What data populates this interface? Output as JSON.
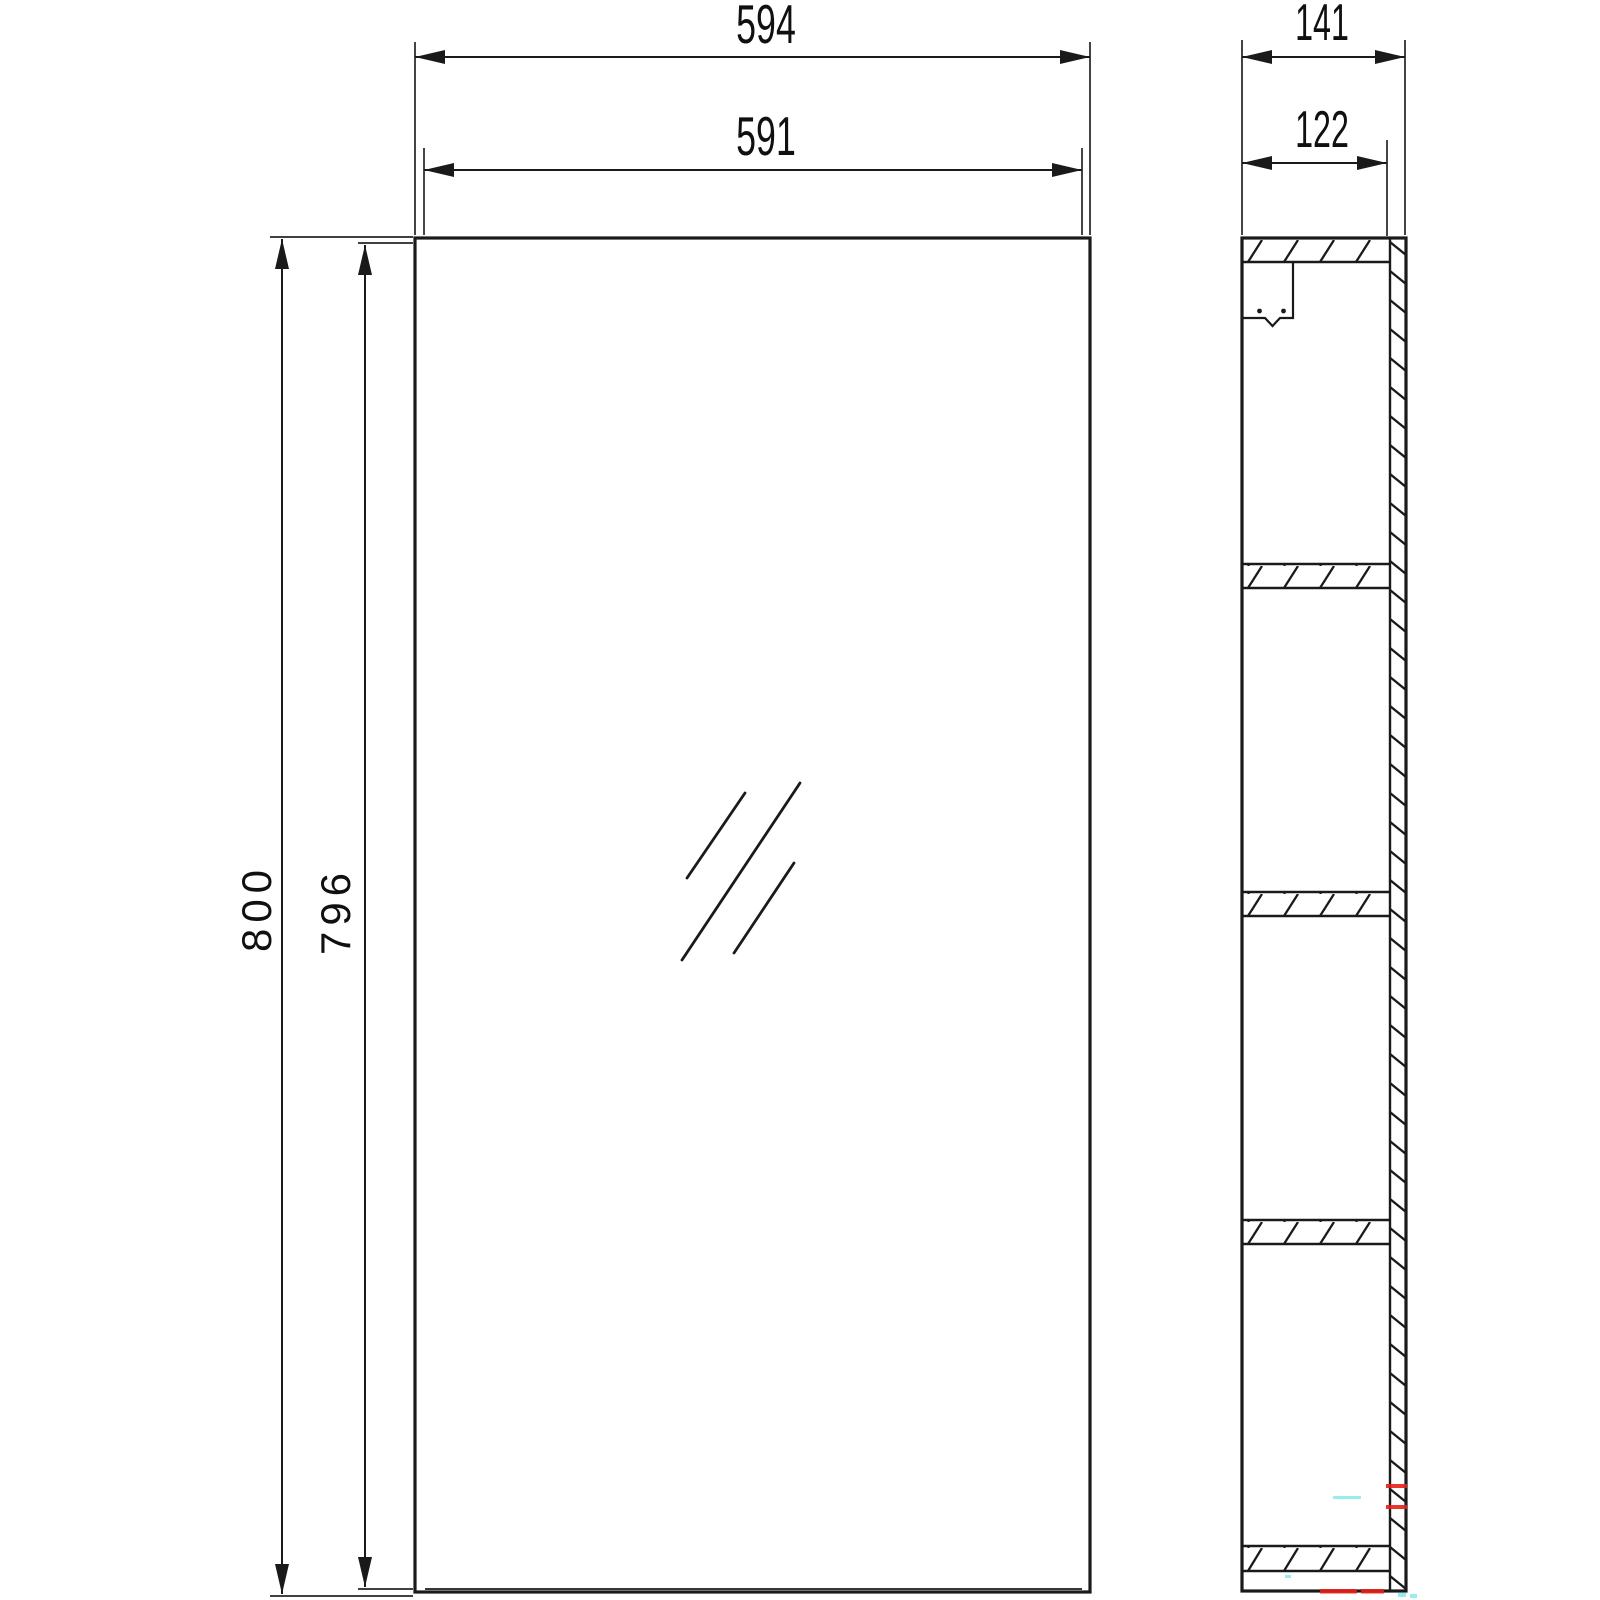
{
  "title": "Mirror cabinet dimensional drawing",
  "units": "mm",
  "front_view": {
    "label": "front view",
    "dims": {
      "overall_width": "594",
      "door_width": "591",
      "overall_height": "800",
      "door_height": "796"
    },
    "glass_mark_count": 3
  },
  "side_view": {
    "label": "side cross-section view",
    "dims": {
      "overall_depth": "141",
      "inner_depth": "122"
    },
    "shelf_band_count": 5,
    "has_mount_bracket": true
  },
  "colors": {
    "line": "#1a1a1a",
    "background": "#ffffff",
    "artifact_red": "#e82019",
    "artifact_cyan": "#8debeb"
  }
}
